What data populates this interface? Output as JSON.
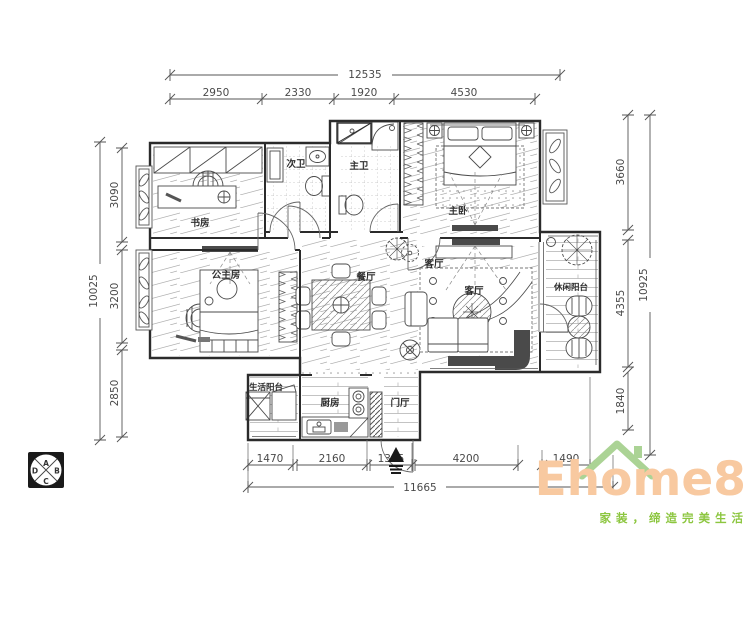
{
  "plan": {
    "dimensions": {
      "top": {
        "total": "12535",
        "segments": [
          "2950",
          "2330",
          "1920",
          "4530"
        ]
      },
      "left": {
        "total": "10025",
        "segments": [
          "3090",
          "3200",
          "2850"
        ]
      },
      "right": {
        "total": "10925",
        "segments": [
          "3660",
          "4355",
          "1840"
        ]
      },
      "bottom": {
        "total": "11665",
        "segments": [
          "1470",
          "2160",
          "1345",
          "4200",
          "1490"
        ]
      }
    },
    "rooms": {
      "study": "书房",
      "guest_bath": "次卫",
      "master_bath": "主卫",
      "master_bedroom": "主卧",
      "princess_room": "公主房",
      "dining_room": "餐厅",
      "living_room": "客厅",
      "leisure_balcony": "休闲阳台",
      "utility_balcony": "生活阳台",
      "kitchen": "厨房",
      "foyer": "门厅"
    }
  },
  "compass": {
    "letters": {
      "a": "A",
      "b": "B",
      "c": "C",
      "d": "D"
    }
  },
  "logo": {
    "brand": "Ehome8",
    "tagline": "家装，缔造完美生活"
  },
  "colors": {
    "background": "#ffffff",
    "wall": "#2b2b2b",
    "line": "#555555",
    "hatch": "#aaaaaa",
    "dark_fill": "#4a4a4a",
    "logo_text": "#f8c9a0",
    "logo_tagline": "#8cc63f",
    "logo_roof": "#abd395"
  }
}
